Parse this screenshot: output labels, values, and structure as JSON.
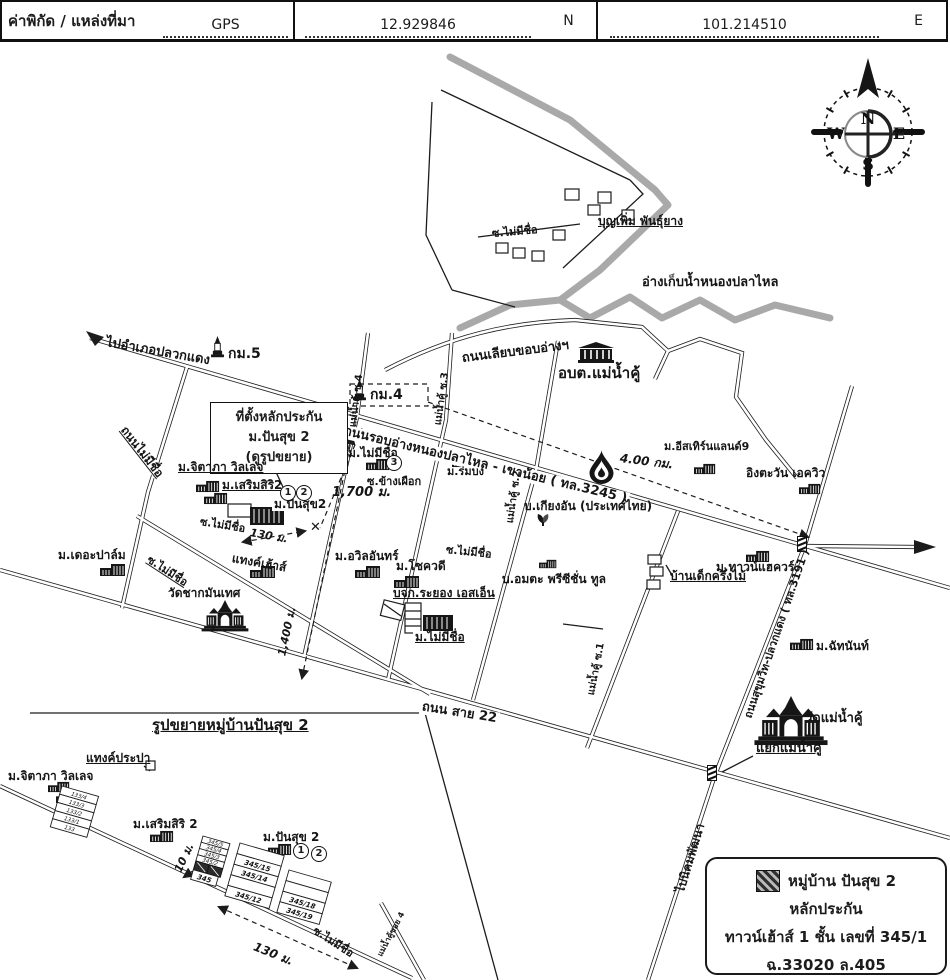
{
  "header": {
    "title": "ค่าพิกัด / แหล่งที่มา",
    "source": "GPS",
    "latitude": "12.929846",
    "latitude_dir": "N",
    "longitude": "101.214510",
    "longitude_dir": "E"
  },
  "compass": {
    "n": "N",
    "e": "E",
    "s": "S",
    "w": "W"
  },
  "map": {
    "roads": {
      "to_pluakdaeng": "ไปอำเภอปลวกแดง",
      "km5": "กม.5",
      "km4": "กม.4",
      "reservoir_edge_road": "ถนนเลียบขอบอ่างฯ",
      "main_road_3245": "ถนนรอบอ่างหนองปลาไหล - เขาน้อย ( ทล.3245 )",
      "unnamed_road": "ถนนไม่มีชื่อ",
      "soi_unnamed_top": "ซ.ไม่มีชื่อ",
      "soi_unnamed_village": "ซ.ไม่มีชื่อ",
      "soi_unnamed_diagonal": "ซ.ไม่มีชื่อ",
      "soi_unnamed_mid": "ซ.ไม่มีชื่อ",
      "maenamkhu_soi4": "แม่น้ำคู้ ซ.4",
      "maenamkhu_soi3": "แม่น้ำคู้ ซ.3",
      "maenamkhu_soi2": "แม่น้ำคู้ ซ.2",
      "maenamkhu_soi1": "แม่น้ำคู้ ซ.1",
      "soi_khangphueak": "ซ.ข้างเผือก",
      "road_sai22": "ถนน สาย 22",
      "sukhumvit_3191": "ถนนสุขุมวิท-ปลวกแดง ( ทล.3191 )",
      "to_nikhomphatthana": "ไปนิคมพัฒนา"
    },
    "places": {
      "boonperm": "บุญเพิ่ม พันธุ์ยาง",
      "reservoir": "อ่างเก็บน้ำหนองปลาไหล",
      "obt_maenamkhu": "อบต.แม่น้ำคู้",
      "jitapha": "ม.จิตาภา วิลเลจ",
      "sermsiri": "ม.เสริมสิริ2",
      "pansuk": "ม.ปันสุข2",
      "thepalm": "ม.เดอะปาล์ม",
      "tankhouse": "แทงค์เฮ้าส์",
      "wat_chakmanthet": "วัดชากมันเทศ",
      "mu_unnamed_3": "ม.ไม่มีชื่อ",
      "mu_unnamed_b": "ม.ไม่มีชื่อ",
      "awil": "ม.อวิลอันทร์",
      "chokwadee": "ม.โชควดี",
      "rayong_sn": "บจก.ระยอง เอสเอ็น",
      "rombong": "ม.ร่มบง",
      "kiangan": "บ.เกียงอัน (ประเทศไทย)",
      "amata": "บ.อมตะ พรีซีชั่น ทูล",
      "bandek": "บ้านเด็กครึ่งไม้",
      "townaquar": "ม.ทาวน์แฮควร์",
      "easternland": "ม.อีสเทิร์นแลนด์9",
      "ingtawan": "อิงตะวัน เอควิว",
      "chatnan": "ม.ฉัทนันท์",
      "wat_maenamkhu": "วัดแม่น้ำคู้",
      "yaek_maenamkhu": "แยกแม่น้ำคู้"
    },
    "collateral_note": {
      "line1": "ที่ตั้งหลักประกัน",
      "line2": "ม.ปันสุข 2",
      "line3": "(ดูรูปขยาย)"
    },
    "distances": {
      "d130": "130 ม.",
      "d1400": "1,400 ม.",
      "d1700": "1,700 ม.",
      "d400km": "4.00 กม."
    },
    "markers": {
      "c1": "1",
      "c2": "2",
      "c3": "3",
      "x": "✕"
    }
  },
  "inset": {
    "title": "รูปขยายหมู่บ้านปันสุข 2",
    "water_tank": "แทงค์ประปา",
    "jitapha": "ม.จิตาภา วิลเลจ",
    "sermsiri": "ม.เสริมสิริ 2",
    "pansuk": "ม.ปันสุข 2",
    "soi_unnamed": "ซ.ไม่มีชื่อ",
    "maenamkhu_soi4": "แม่น้ำคู้ซอย 4",
    "d10": "10 ม.",
    "d130": "130 ม.",
    "plots_133": [
      "133/4",
      "133/3",
      "133/2",
      "133/1",
      "133"
    ],
    "plots_345_left": [
      "345/5",
      "345/4",
      "345/3",
      "345/2"
    ],
    "plot_345": "345",
    "plots_345_mid": [
      "345/15",
      "345/14",
      "345/12"
    ],
    "plots_345_right": [
      "345/18",
      "345/19"
    ],
    "markers": {
      "c1": "1",
      "c2": "2"
    }
  },
  "legend": {
    "name": "หมู่บ้าน ปันสุข 2",
    "type": "หลักประกัน",
    "detail": "ทาวน์เฮ้าส์ 1 ชั้น เลขที่ 345/1",
    "deed": "ฉ.33020 ล.405",
    "area": "เนื้อที่ 28.0 ตารางวา"
  },
  "colors": {
    "ink": "#1c1c1c",
    "water": "#a9a9a9",
    "paper": "#ffffff"
  }
}
